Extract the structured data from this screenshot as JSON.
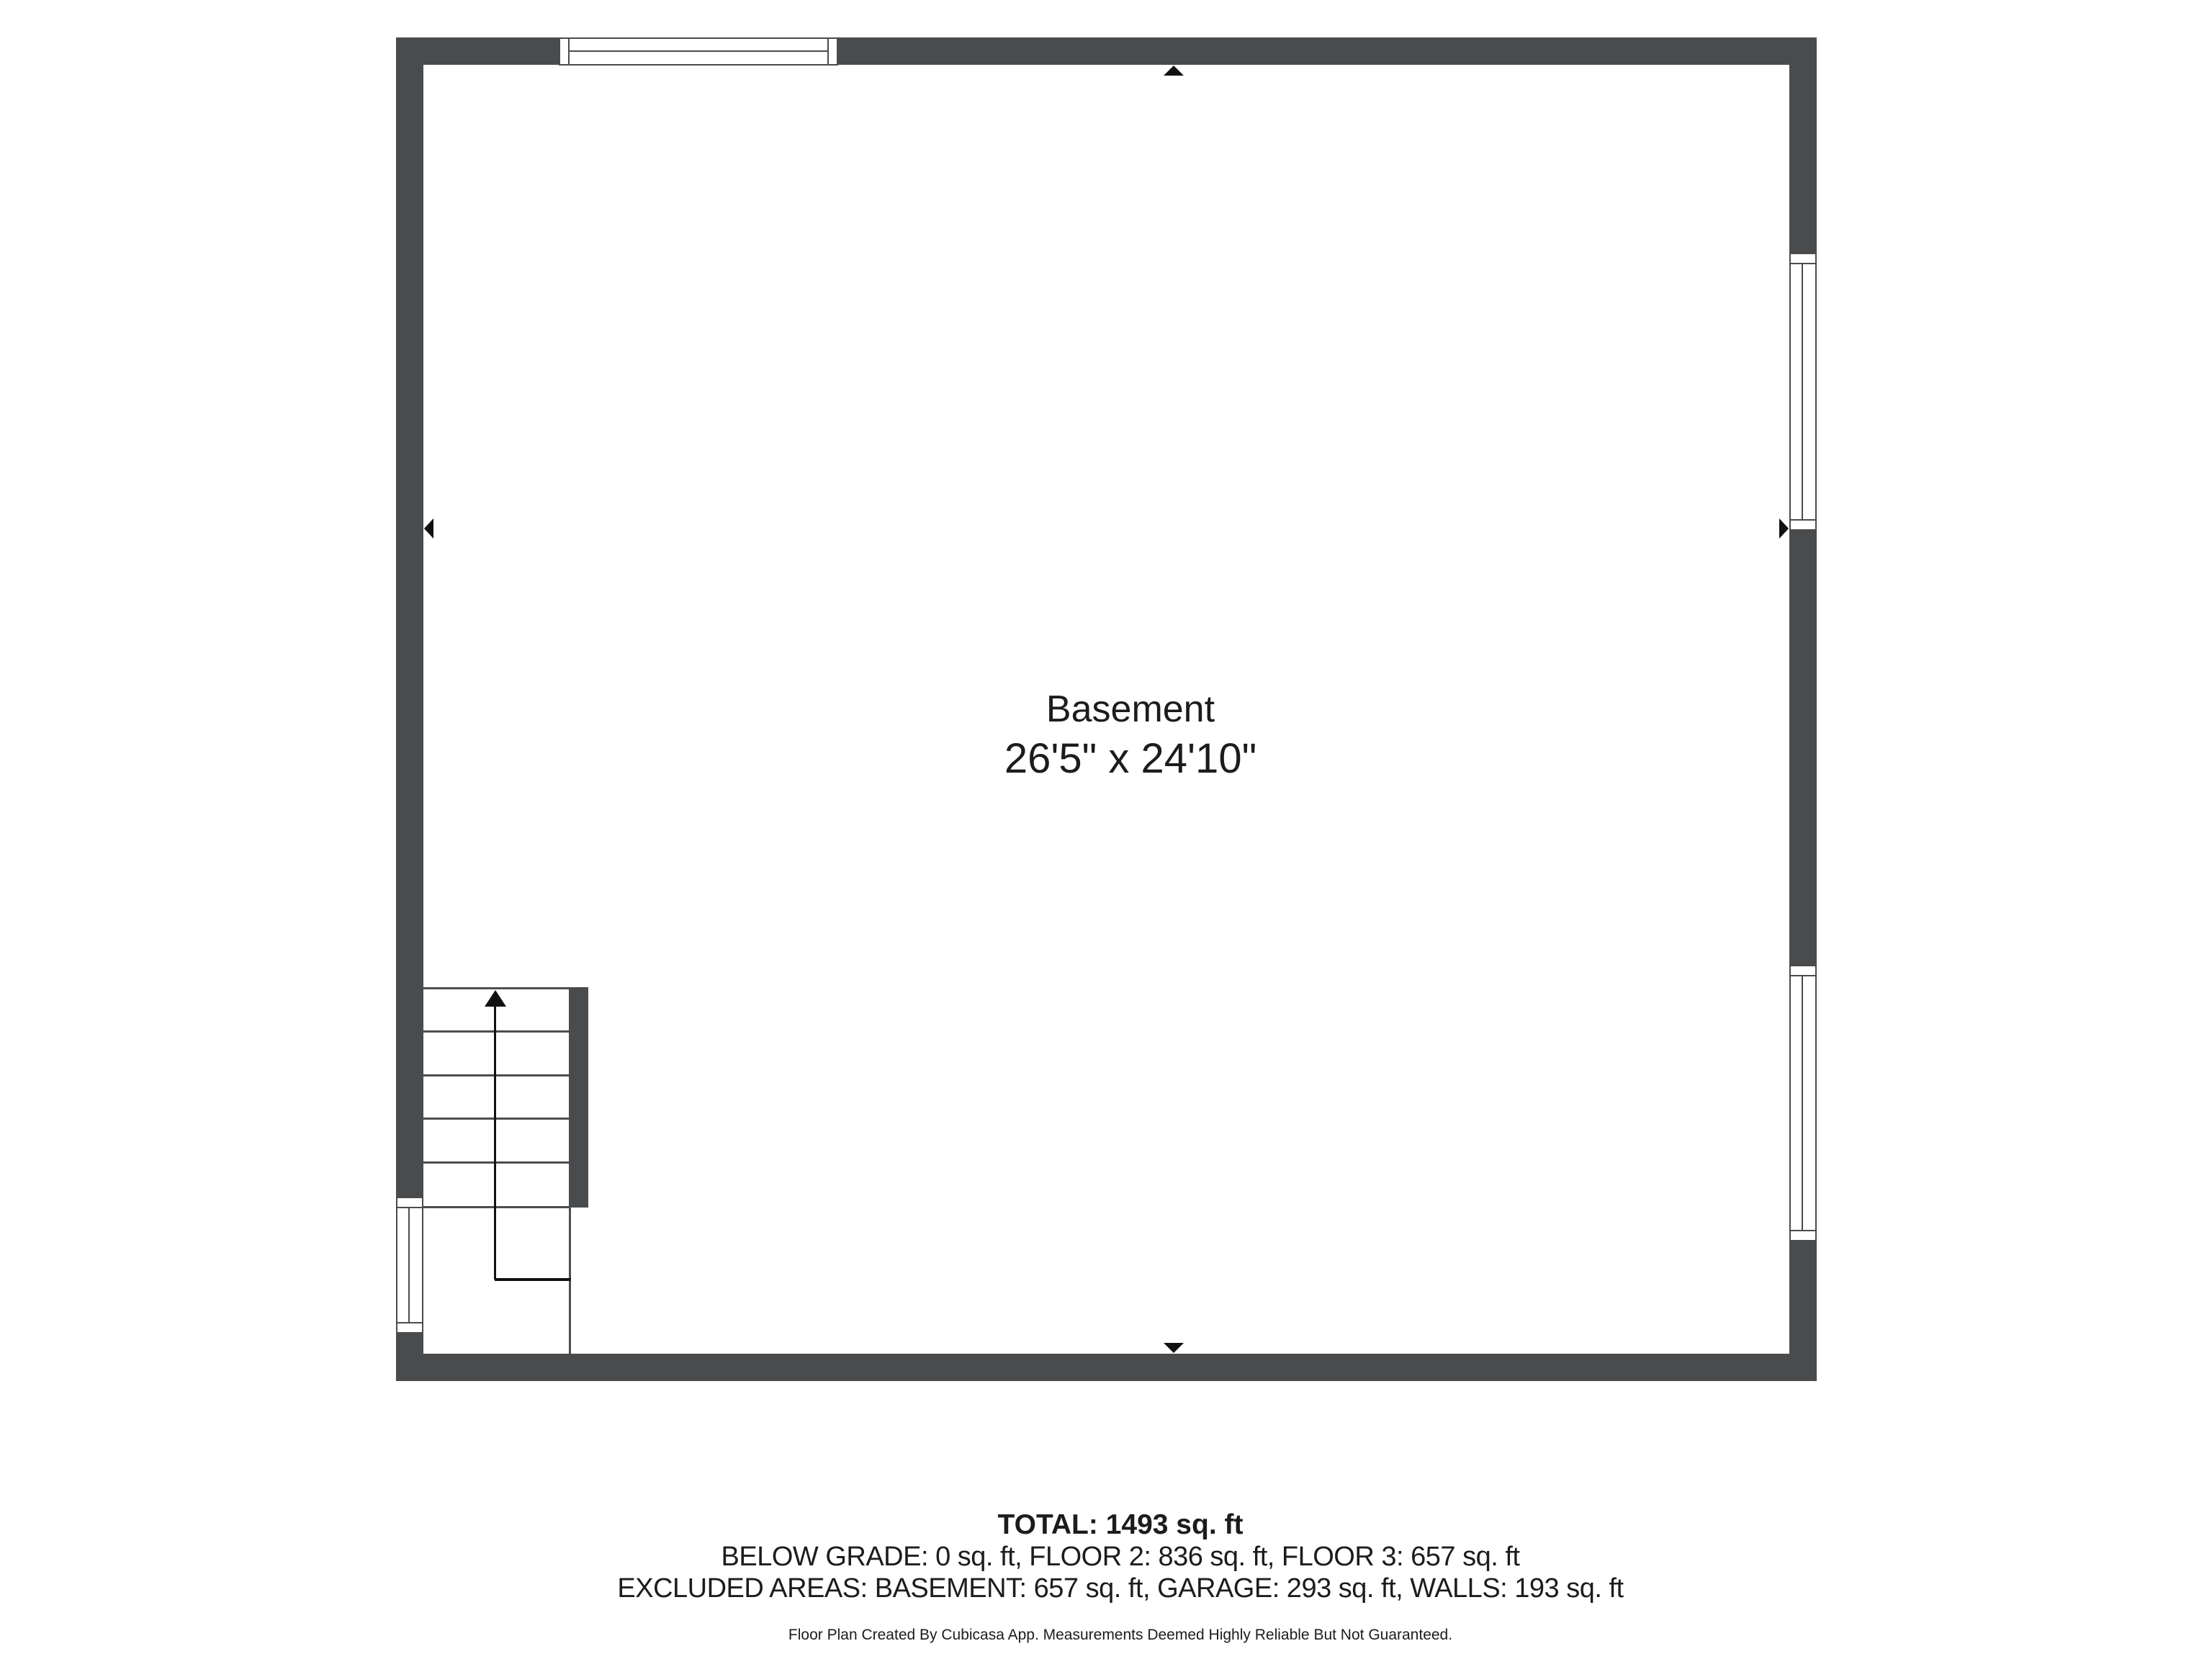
{
  "floor_plan": {
    "room": {
      "name": "Basement",
      "dimensions": "26'5\" x 24'10\""
    },
    "icons": {
      "stair_up_arrow": "solid black triangle pointing up along stair walking line",
      "wall_marker_top": "small black triangle pointing up at inner top wall",
      "wall_marker_bottom": "small black triangle pointing down at inner bottom wall",
      "wall_marker_left": "small black triangle pointing left at inner left wall",
      "wall_marker_right": "small black triangle pointing right at inner right wall"
    },
    "colors": {
      "wall": "#494b4d",
      "stair_line": "#4c4e50",
      "marker": "#111111",
      "text_primary": "#1c1c1e",
      "page_bg": "#ffffff"
    }
  },
  "summary": {
    "total_label": "TOTAL: 1493 sq. ft",
    "floors_label": "BELOW GRADE: 0 sq. ft, FLOOR 2: 836 sq. ft, FLOOR 3: 657 sq. ft",
    "excluded_label": "EXCLUDED AREAS: BASEMENT: 657 sq. ft, GARAGE: 293 sq. ft, WALLS: 193 sq. ft",
    "disclaimer": "Floor Plan Created By Cubicasa App. Measurements Deemed Highly Reliable But Not Guaranteed.",
    "areas": {
      "total_sq_ft": 1493,
      "below_grade_sq_ft": 0,
      "floor_2_sq_ft": 836,
      "floor_3_sq_ft": 657,
      "excluded": {
        "basement_sq_ft": 657,
        "garage_sq_ft": 293,
        "walls_sq_ft": 193
      }
    }
  }
}
